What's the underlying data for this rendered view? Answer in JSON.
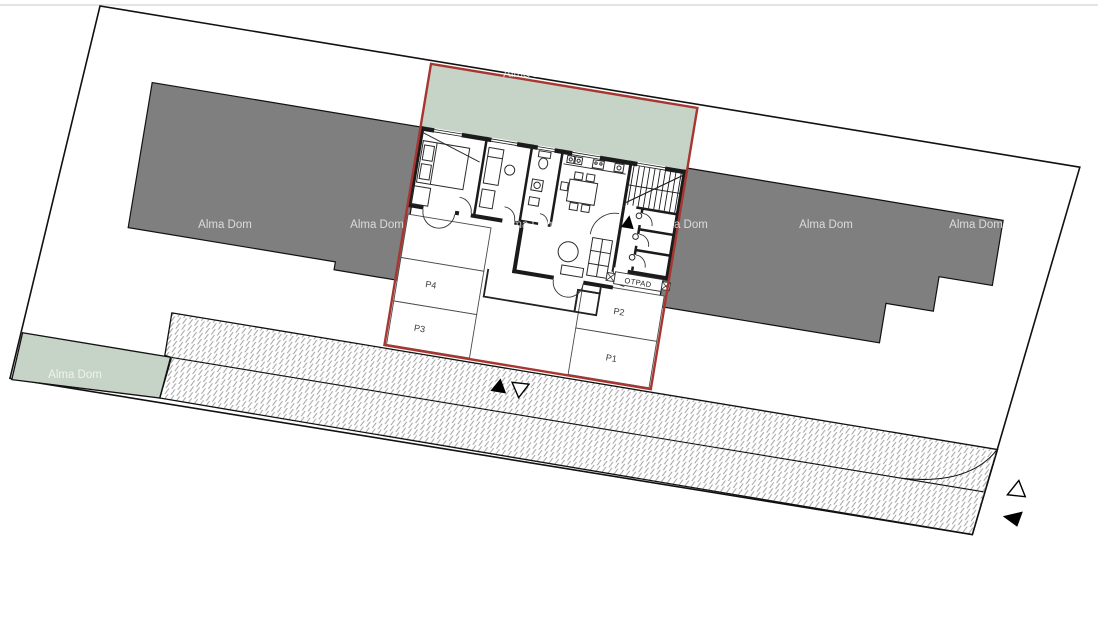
{
  "watermark": {
    "text": "Alma Dom"
  },
  "parking_labels": {
    "p1": "P1",
    "p2": "P2",
    "p3": "P3",
    "p4": "P4"
  },
  "labels": {
    "waste_area": "OTPAD"
  },
  "colors": {
    "page_background": "#ffffff",
    "garden_green": "#c6d3c7",
    "neighbor_building_gray": "#7f7f7f",
    "plot_boundary_red": "#a93531",
    "site_boundary_black": "#111111",
    "wall_black": "#1b1b1b",
    "hatch_line_gray": "#9a9a9a"
  }
}
